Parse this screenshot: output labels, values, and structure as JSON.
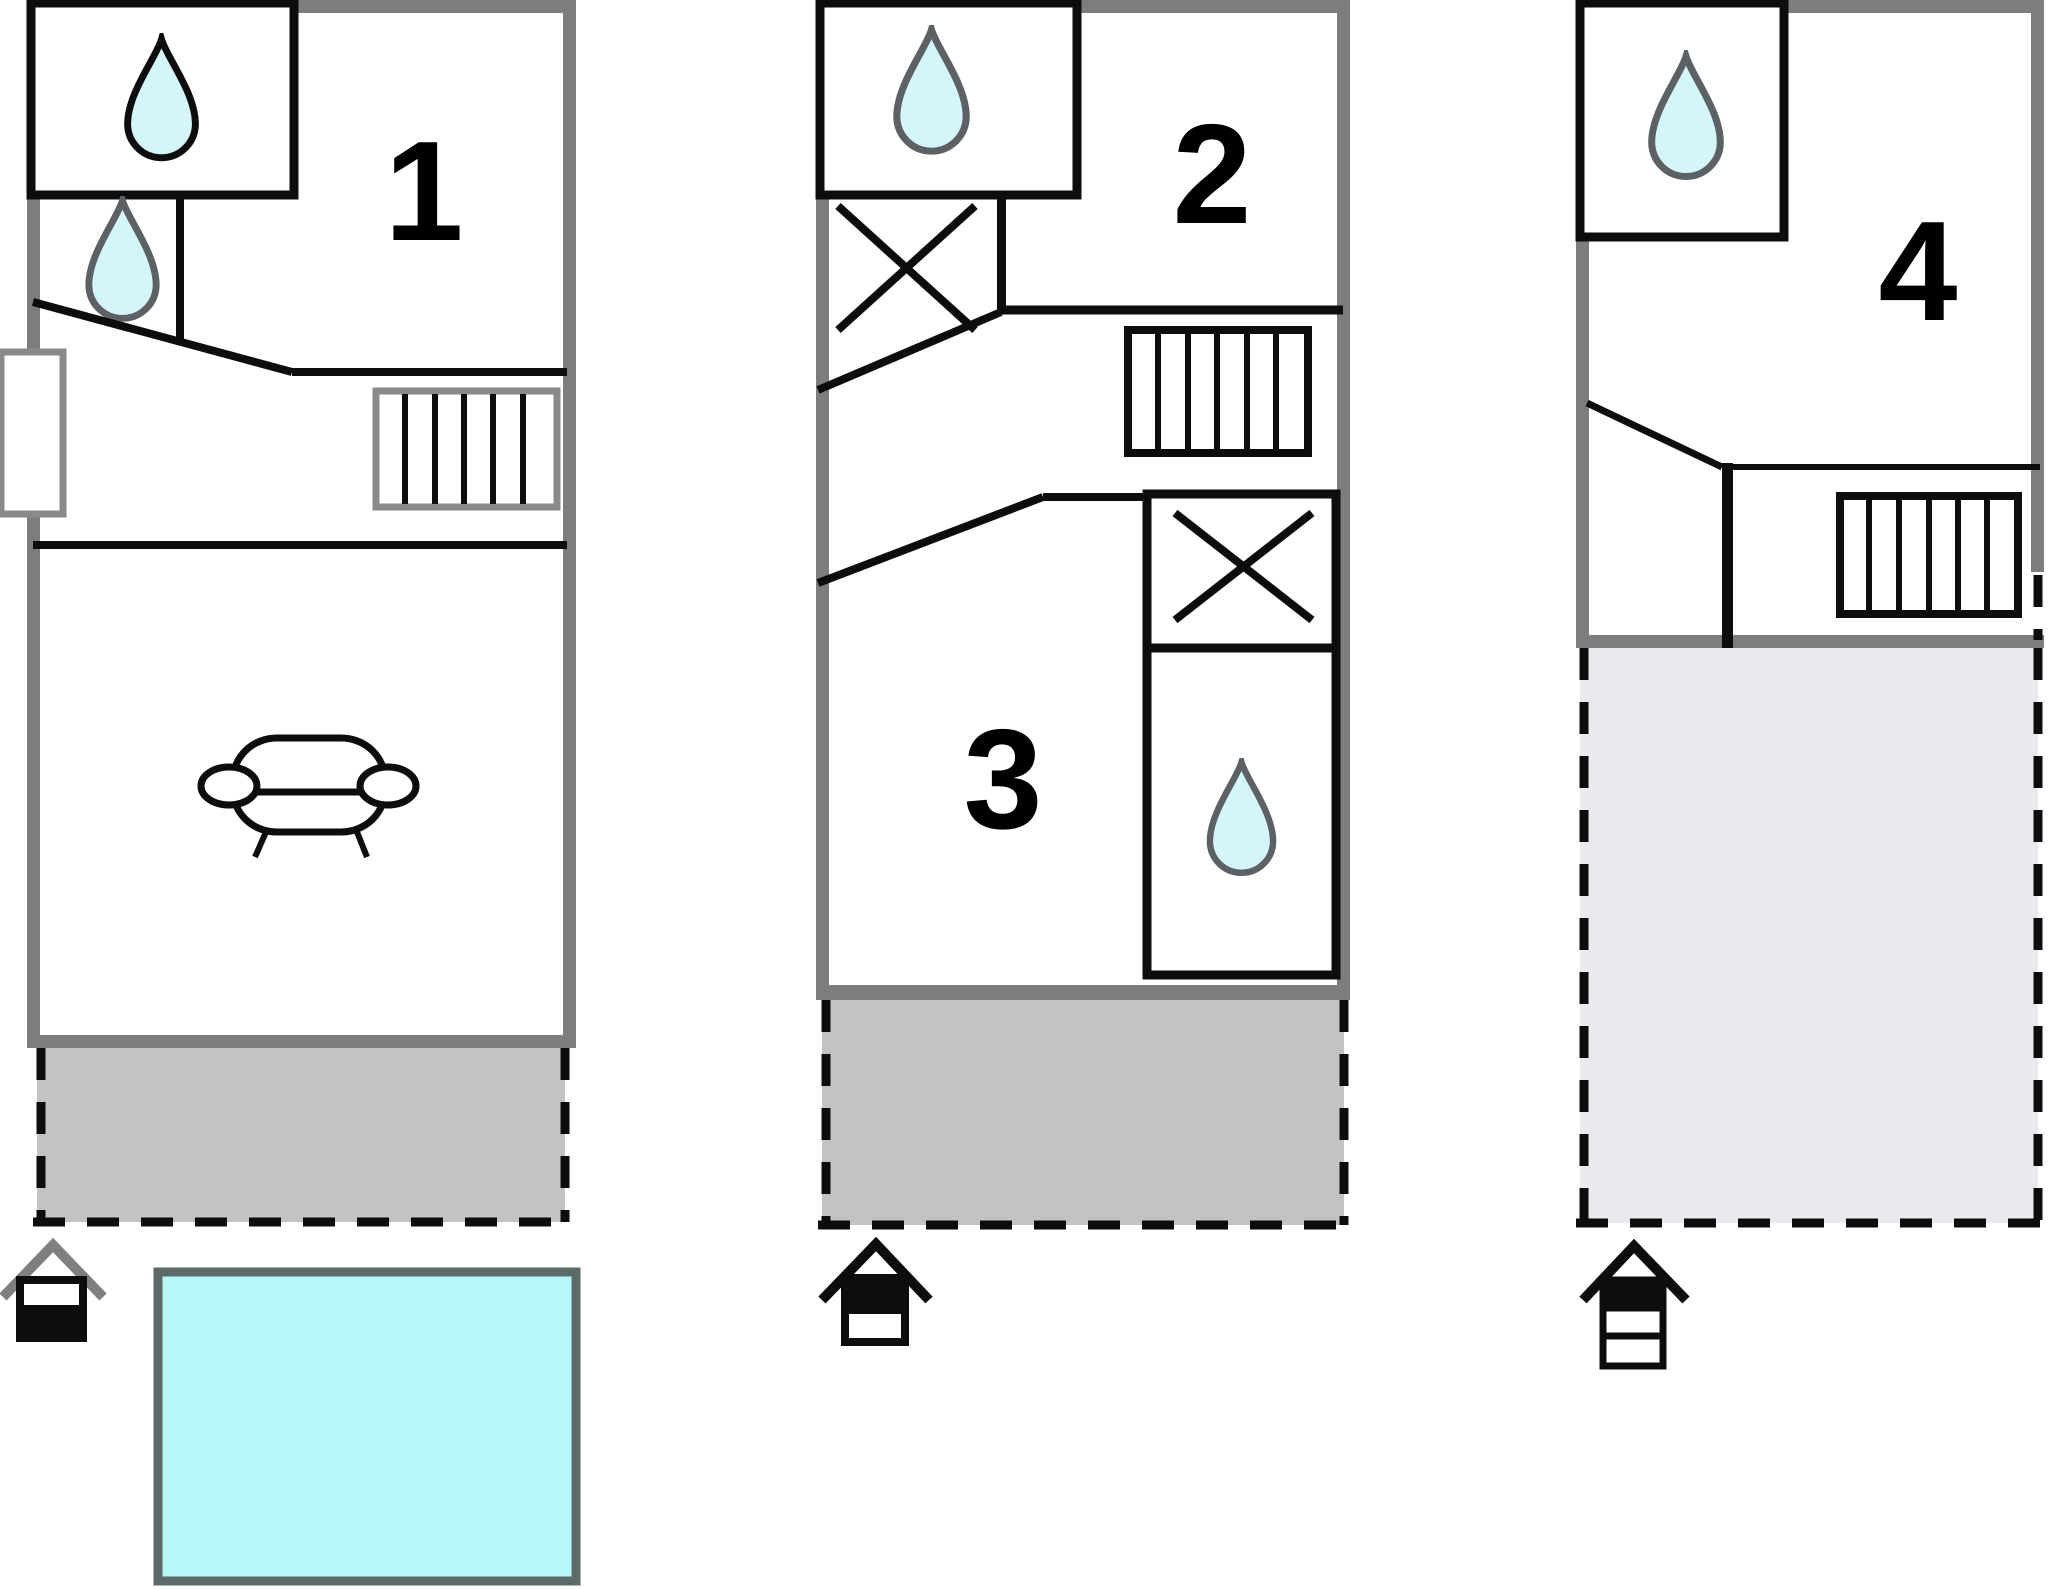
{
  "floorplan": {
    "title": "three-level holiday house floor plan",
    "units": [
      {
        "id": "unit-1",
        "label": "1",
        "features": [
          "shower-drop",
          "washbasin-drop",
          "window",
          "staircase",
          "sofa",
          "covered-terrace",
          "pool",
          "entrance-marker-lower-level"
        ]
      },
      {
        "id": "unit-2",
        "label": "2",
        "features": [
          "shower-drop",
          "wardrobe-cross",
          "staircase"
        ]
      },
      {
        "id": "unit-3",
        "label": "3",
        "features": [
          "wardrobe-cross",
          "shower-drop",
          "covered-terrace",
          "entrance-marker-upper-level"
        ]
      },
      {
        "id": "unit-4",
        "label": "4",
        "features": [
          "shower-drop",
          "staircase",
          "roof-terrace",
          "entrance-marker-top-level"
        ]
      }
    ],
    "icons": {
      "water_drop": "drop-icon",
      "wardrobe": "wardrobe-x-icon",
      "entrance": "entrance-house-icon",
      "sofa": "sofa-icon",
      "stairs": "stairs-icon",
      "window": "window-icon",
      "pool": "pool-shape"
    },
    "colors": {
      "wall_gray": "#7d7d7d",
      "line_black": "#0d0d0d",
      "drop_fill": "#d4f6fa",
      "drop_stroke_dark": "#0d0d0d",
      "drop_stroke_gray": "#5b6165",
      "terrace_gray": "#c3c3c3",
      "roof_terrace_light": "#e9e9ee",
      "pool_fill": "#b6f8f8",
      "pool_border": "#5d6a6a",
      "stairs_border_gray": "#8a8a8a",
      "window_border": "#8a8a8a",
      "roof_gray": "#7f7f7f",
      "label_color": "#000000"
    }
  }
}
